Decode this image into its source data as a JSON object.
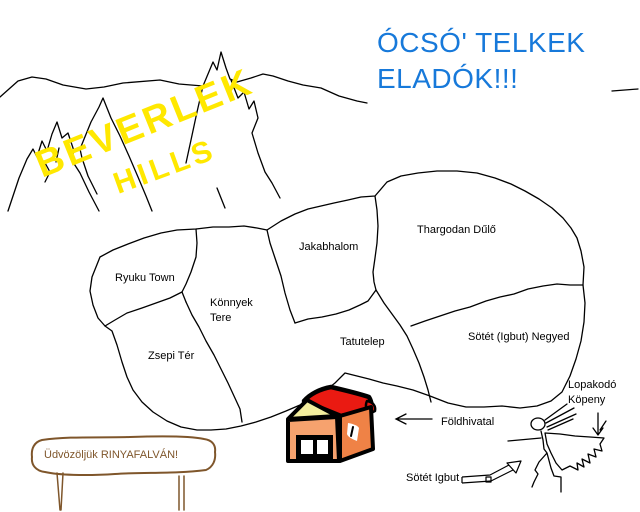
{
  "headline": {
    "line1": "ÓCSÓ' TELKEK",
    "line2": "ELADÓK!!!",
    "color": "#1779da"
  },
  "hills": {
    "line1": "BEVERLEK",
    "line2": "HILLS",
    "color": "#ffe800"
  },
  "map_regions": [
    {
      "name": "Ryuku Town",
      "lines": [
        "Ryuku Town"
      ]
    },
    {
      "name": "Jakabhalom",
      "lines": [
        "Jakabhalom"
      ]
    },
    {
      "name": "Thargodan Dűlő",
      "lines": [
        "Thargodan Dűlő"
      ]
    },
    {
      "name": "Könnyek Tere",
      "lines": [
        "Könnyek",
        "Tere"
      ]
    },
    {
      "name": "Zsepi Tér",
      "lines": [
        "Zsepi Tér"
      ]
    },
    {
      "name": "Tatutelep",
      "lines": [
        "Tatutelep"
      ]
    },
    {
      "name": "Sötét (Igbut) Negyed",
      "lines": [
        "Sötét (Igbut) Negyed"
      ]
    }
  ],
  "callouts": {
    "cloak": {
      "name": "Lopakodó Köpeny",
      "line1": "Lopakodó",
      "line2": "Köpeny"
    },
    "land_office": {
      "label": "Földhivatal"
    },
    "dark_igbut": {
      "label": "Sötét Igbut"
    }
  },
  "welcome_sign": {
    "text": "Üdvözöljük RINYAFALVÁN!",
    "color": "#7f562b"
  },
  "house": {
    "colors": {
      "roof": "#ea1a12",
      "gable": "#f3ee9e",
      "front_wall": "#f6a26e",
      "side_wall": "#ef8246"
    }
  },
  "icons": {
    "land_office_arrow": "left-arrow",
    "dark_igbut_arrow": "up-right-arrow",
    "cloak_pointer": "down-arrow"
  }
}
